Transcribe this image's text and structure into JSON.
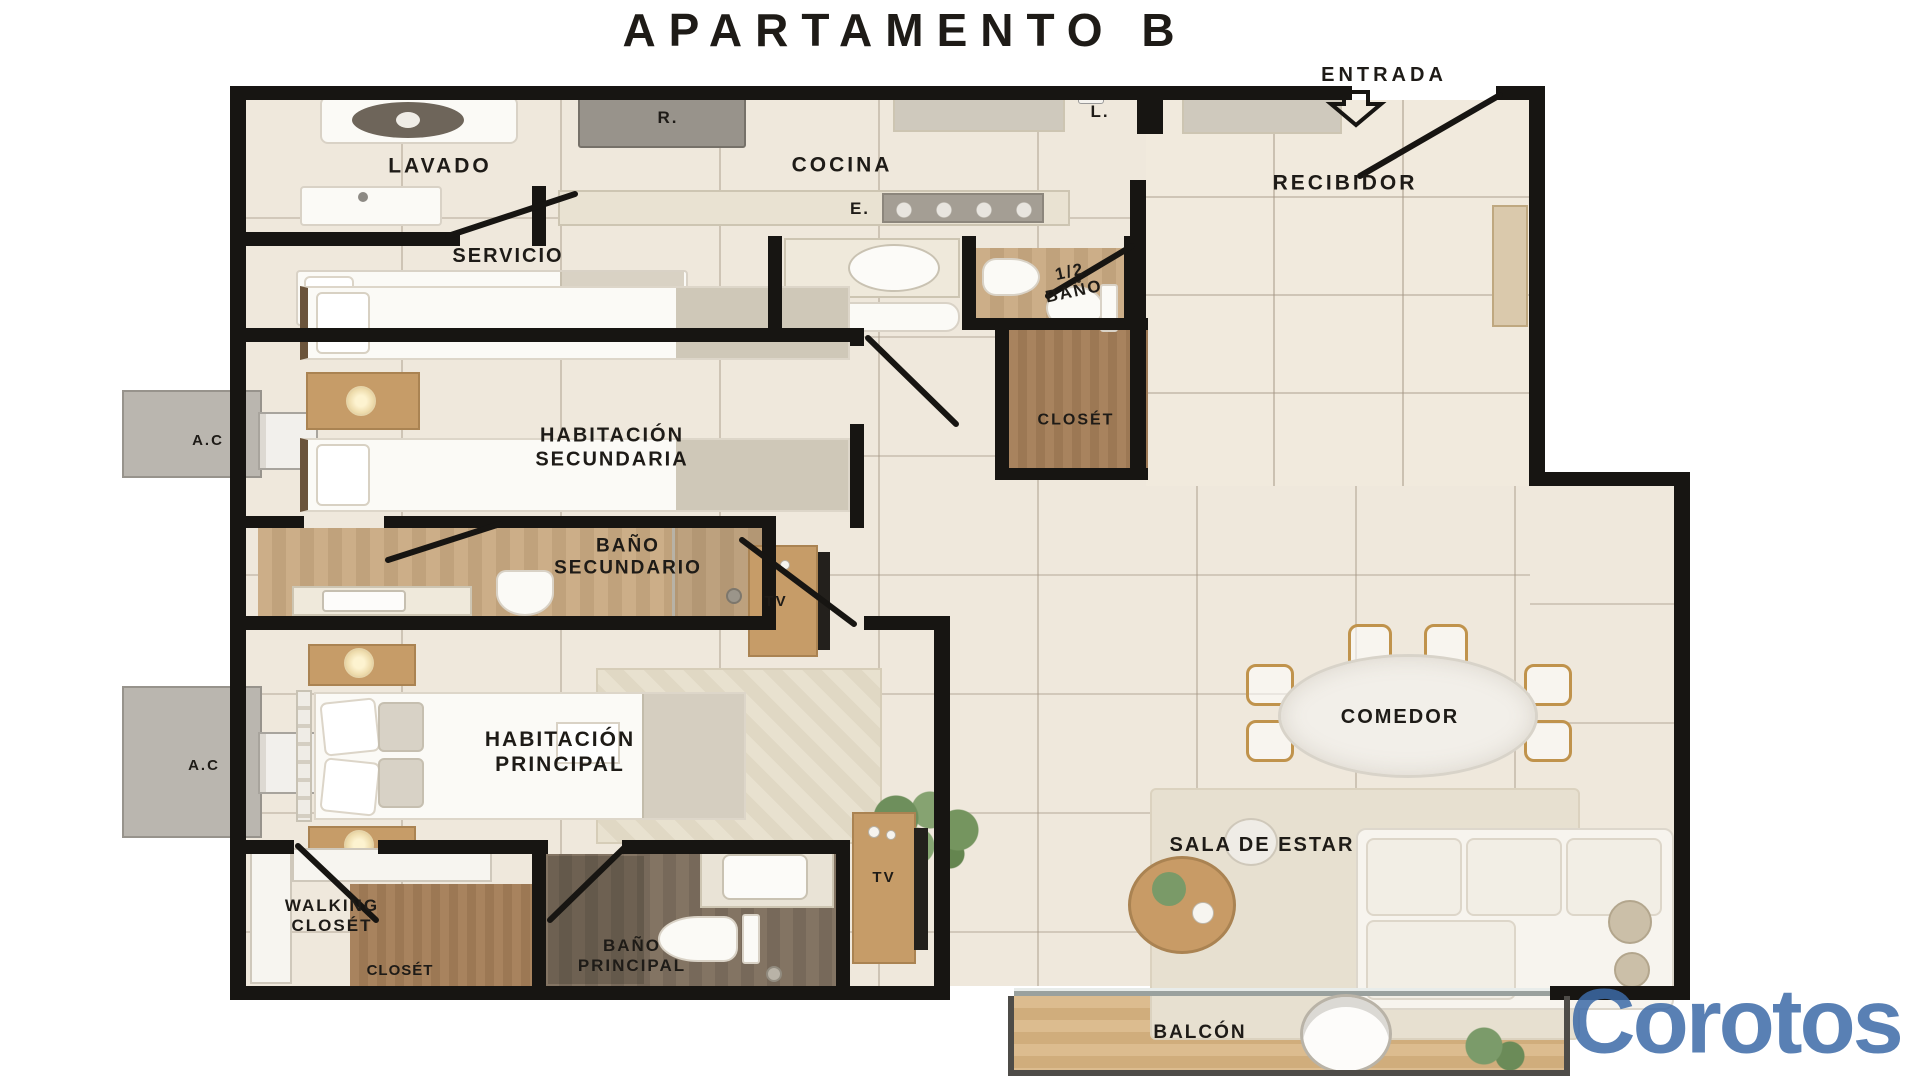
{
  "title": "APARTAMENTO B",
  "entry": {
    "label": "ENTRADA"
  },
  "rooms": {
    "lavado": "LAVADO",
    "cocina": "COCINA",
    "recibidor": "RECIBIDOR",
    "servicio": "SERVICIO",
    "medio_bano": "1/2\nBAÑO",
    "habitacion_secundaria": "HABITACIÓN\nSECUNDARIA",
    "closet_pasillo": "CLOSÉT",
    "bano_secundario": "BAÑO\nSECUNDARIO",
    "habitacion_principal": "HABITACIÓN\nPRINCIPAL",
    "walking_closet": "WALKING\nCLOSÉT",
    "closet_walking": "CLOSÉT",
    "bano_principal": "BAÑO\nPRINCIPAL",
    "comedor": "COMEDOR",
    "sala_de_estar": "SALA DE ESTAR",
    "balcon": "BALCÓN"
  },
  "equipment": {
    "fridge": "R.",
    "sink": "L.",
    "stove": "E.",
    "ac_1": "A.C",
    "ac_2": "A.C",
    "tv_master": "TV",
    "tv_sala": "TV"
  },
  "watermark": "Corotos",
  "colors": {
    "wall": "#171512",
    "tile_floor": "#efe8dc",
    "closet_wood": "#a8835e",
    "bath_wood": "#ccae88",
    "dark_bath_wood": "#837463",
    "balcony_wood": "#dcbc8f",
    "watermark_blue": "#3c6aa7"
  }
}
